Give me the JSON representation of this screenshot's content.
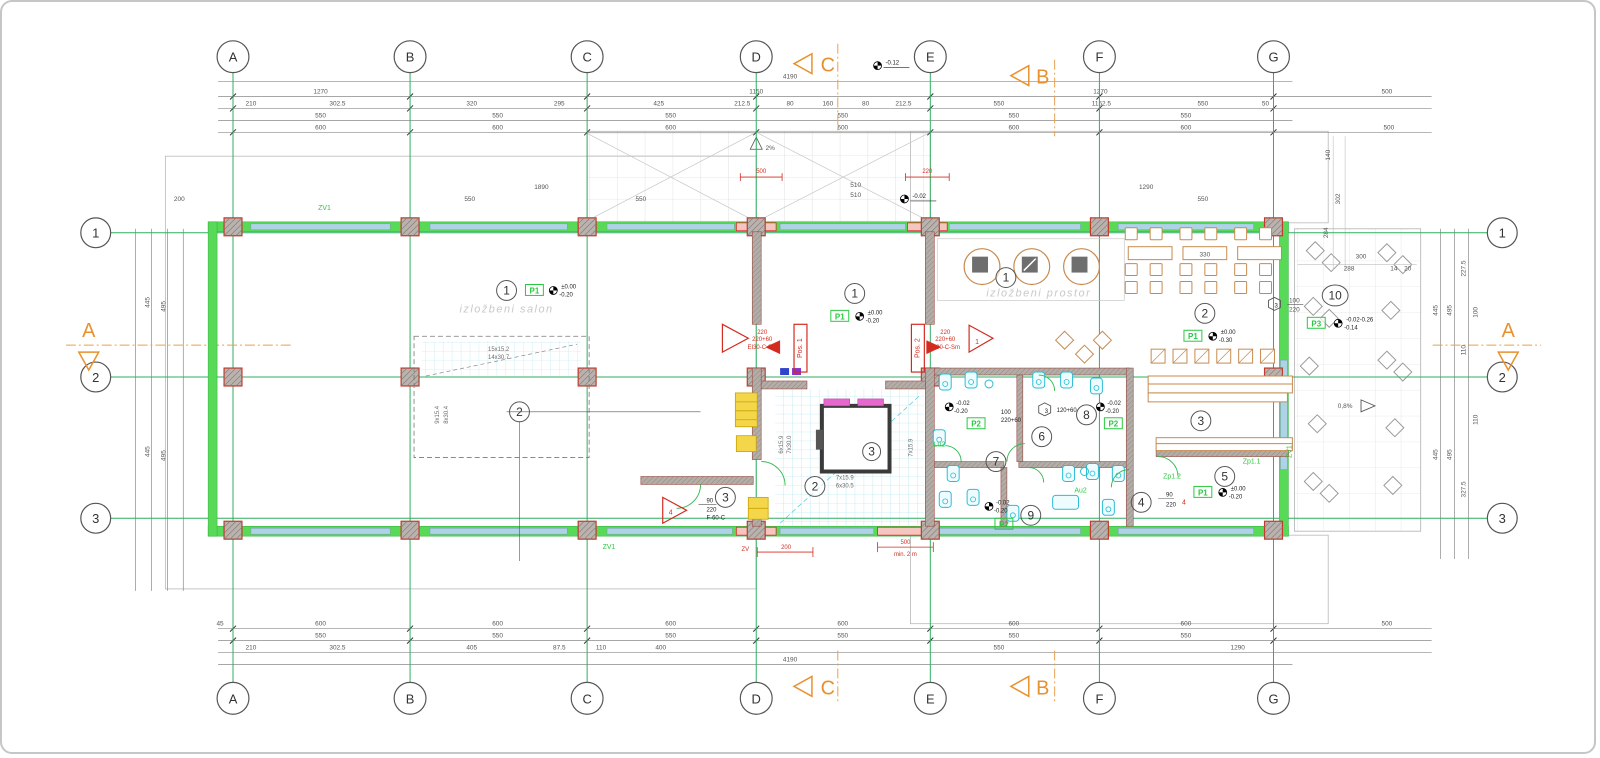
{
  "axes": {
    "cols": [
      "A",
      "B",
      "C",
      "D",
      "E",
      "F",
      "G"
    ],
    "rows": [
      "1",
      "2",
      "3"
    ]
  },
  "sections": {
    "a": "A",
    "b": "B",
    "c": "C"
  },
  "rooms": {
    "salon": {
      "no": "1",
      "floor": "P1",
      "name": "izložbeni salon",
      "et": "±0.00",
      "eb": "-0.20"
    },
    "left2": {
      "no": "2"
    },
    "left3": {
      "no": "3"
    },
    "hall1": {
      "no": "1",
      "floor": "P1",
      "et": "±0.00",
      "eb": "-0.20"
    },
    "stair2": {
      "no": "2"
    },
    "lift3": {
      "no": "3"
    },
    "expo": {
      "no": "1",
      "name": "izložbeni prostor"
    },
    "cafe": {
      "no": "2",
      "floor": "P1",
      "et": "±0.00",
      "eb": "-0.30"
    },
    "bar": {
      "no": "3"
    },
    "r4": {
      "no": "4"
    },
    "r5": {
      "no": "5",
      "floor": "P1",
      "et": "±0.00",
      "eb": "-0.20"
    },
    "r6": {
      "no": "6"
    },
    "r7": {
      "no": "7"
    },
    "r8": {
      "no": "8"
    },
    "r9": {
      "no": "9"
    },
    "terrace": {
      "no": "10",
      "floor": "P3",
      "et": "-0.02-0.26",
      "eb": "-0.14"
    }
  },
  "plabels": {
    "p1": "P1",
    "p2": "P2",
    "p3": "P3"
  },
  "doors": {
    "pos1": {
      "tag": "Pos. 1",
      "d1": "220",
      "d2": "220+60",
      "r": "EI30-C-Sm"
    },
    "pos2": {
      "tag": "Pos. 2",
      "d1": "220",
      "d2": "220+60",
      "r": "EI90-C-Sm"
    },
    "t1": {
      "no": "1"
    },
    "t4": {
      "no": "4",
      "d1": "90",
      "d2": "220",
      "r": "F-60-C"
    },
    "h3a": {
      "no": "3",
      "d1": "100",
      "d2": "220"
    },
    "h3b": {
      "no": "3",
      "d1": "120+60"
    }
  },
  "stairs": {
    "s1": "7x15.9",
    "s2": "6x30.5",
    "s3": "6x15.9",
    "s4": "7x30.0",
    "l1": "15x15.2",
    "l2": "14x30.7",
    "l3": "9x15.4",
    "l4": "8x30.4"
  },
  "labels": {
    "zv1": "ZV1",
    "zv": "ZV",
    "zp11": "Zp1.1",
    "zp12": "Zp1.2",
    "lu2": "Lu2",
    "au2": "Au2",
    "pct2": "2%",
    "pct08": "0,8%",
    "min2m": "min. 2 m"
  },
  "elev": {
    "z": "±0.00",
    "m20": "-0.20",
    "m02": "-0.02",
    "m12": "-0.12"
  },
  "dims": {
    "total": "4190",
    "top1": [
      "1270",
      "1150",
      "1270",
      "500"
    ],
    "top2": [
      "210",
      "302.5",
      "320",
      "295",
      "425",
      "212.5",
      "80",
      "160",
      "80",
      "212.5",
      "550",
      "1152.5",
      "550",
      "50"
    ],
    "top3": [
      "550",
      "550",
      "550",
      "550",
      "550",
      "550"
    ],
    "top4": [
      "600",
      "600",
      "600",
      "600",
      "600",
      "600"
    ],
    "canopy1": [
      "1890",
      "510",
      "510",
      "1290"
    ],
    "canopy2": [
      "550",
      "550",
      "550"
    ],
    "bot1": [
      "600",
      "600",
      "600",
      "600",
      "600",
      "600",
      "45",
      "500"
    ],
    "bot2": [
      "550",
      "550",
      "550",
      "550",
      "550",
      "550"
    ],
    "bot3": [
      "210",
      "302.5",
      "405",
      "87.5",
      "110",
      "400",
      "550",
      "1290"
    ],
    "left": [
      "200",
      "445",
      "495",
      "445",
      "495"
    ],
    "right": [
      "445",
      "495",
      "227.5",
      "100",
      "110",
      "445",
      "495",
      "327.5",
      "110"
    ],
    "corner": [
      "500",
      "140",
      "302",
      "284",
      "300",
      "288",
      "14",
      "20"
    ],
    "red500": "500",
    "red200": "200",
    "red220": "220",
    "d330": "330",
    "d100": "100",
    "d22060": "220+60",
    "d90": "90",
    "d220": "220"
  }
}
